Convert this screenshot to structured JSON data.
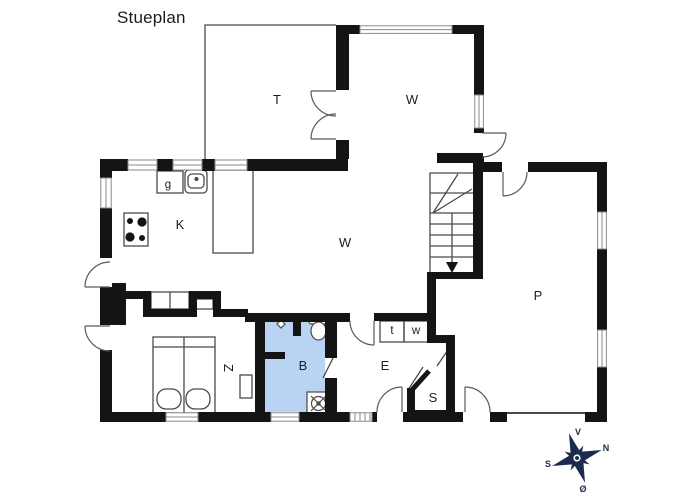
{
  "title": "Stueplan",
  "rooms": [
    {
      "id": "terrace",
      "label": "T"
    },
    {
      "id": "living-upper",
      "label": "W"
    },
    {
      "id": "utility-nook",
      "label": "g"
    },
    {
      "id": "kitchen",
      "label": "K"
    },
    {
      "id": "living-room",
      "label": "W"
    },
    {
      "id": "bedroom",
      "label": "Z"
    },
    {
      "id": "bathroom",
      "label": "B"
    },
    {
      "id": "entry-hall",
      "label": "E"
    },
    {
      "id": "toilet-closet",
      "label": "t"
    },
    {
      "id": "washer-closet",
      "label": "w"
    },
    {
      "id": "storage-room",
      "label": "S"
    },
    {
      "id": "room-p",
      "label": "P"
    }
  ],
  "compass": {
    "west": "V",
    "north": "N",
    "south": "S",
    "east": "Ø"
  },
  "colors": {
    "wall": "#141414",
    "thin_line": "#4a4a4a",
    "window_frame": "#8a8a8a",
    "bathroom_fill": "#b9d3f2",
    "compass_navy": "#1c2b4d"
  }
}
